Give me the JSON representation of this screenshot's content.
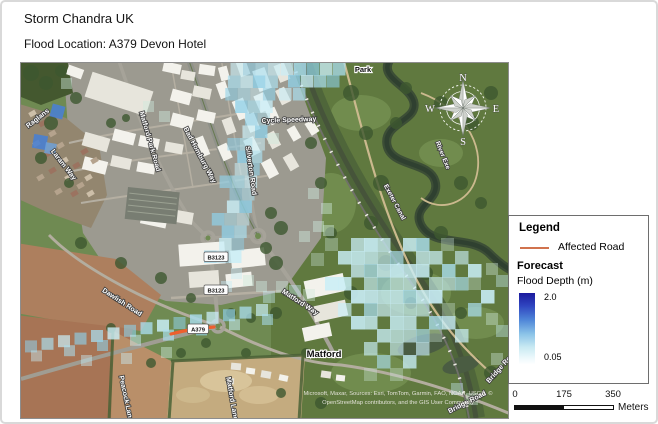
{
  "header": {
    "title": "Storm Chandra UK",
    "subtitle": "Flood Location: A379 Devon Hotel"
  },
  "map": {
    "place_labels": {
      "park": "Park",
      "matford": "Matford"
    },
    "road_labels": {
      "raglans": "Raglans",
      "laram_way": "Laram Way",
      "matford_park_road": "Matford Park Road",
      "bad_homburg_way": "Bad Homburg Way",
      "silverton_road": "Silverton Road",
      "cycle_speedway": "Cycle Speedway",
      "dawlish_road": "Dawlish Road",
      "matford_way": "Matford Way",
      "peacock_lane": "Peacock Lane",
      "matford_lane": "Matford Lane",
      "bridge_road": "Bridge Road"
    },
    "water_labels": {
      "river_exe": "River Exe",
      "exeter_canal": "Exeter Canal"
    },
    "route_badges": {
      "b3123": "B3123",
      "a379": "A379"
    },
    "compass": {
      "n": "N",
      "e": "E",
      "s": "S",
      "w": "W"
    },
    "attribution_line1": "Microsoft, Maxar, Sources: Esri, TomTom, Garmin, FAO, NOAA, USGS, ©",
    "attribution_line2": "OpenStreetMap contributors, and the GIS User Community"
  },
  "legend": {
    "title": "Legend",
    "affected_road_label": "Affected Road",
    "affected_road_color": "#d1734e",
    "map_affected_road_color": "#ee5f2e",
    "forecast_title": "Forecast",
    "flood_depth_label": "Flood Depth (m)",
    "max_value": "2.0",
    "min_value": "0.05",
    "gradient_top": "#1b1b9e",
    "gradient_bottom": "#fdfeff",
    "flood_light": "#c9eef7"
  },
  "scalebar": {
    "tick0": "0",
    "tick1": "175",
    "tick2": "350",
    "unit": "Meters"
  }
}
